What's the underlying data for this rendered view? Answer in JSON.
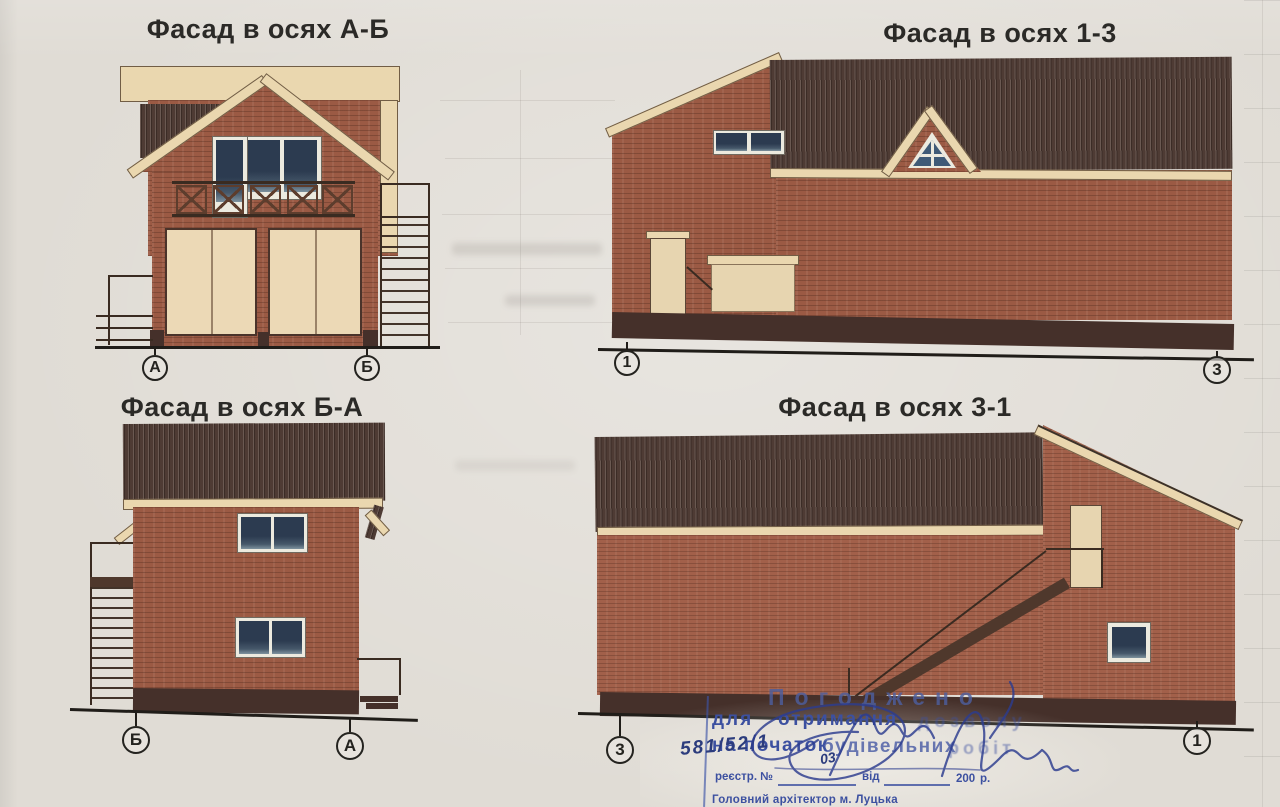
{
  "facades": [
    {
      "title": "Фасад в осях А-Б",
      "axis_left": "А",
      "axis_right": "Б"
    },
    {
      "title": "Фасад в осях 1-3",
      "axis_left": "1",
      "axis_right": "3"
    },
    {
      "title": "Фасад в осях Б-А",
      "axis_left": "Б",
      "axis_right": "А"
    },
    {
      "title": "Фасад в осях 3-1",
      "axis_left": "3",
      "axis_right": "1"
    }
  ],
  "stamp": {
    "approved": "Погоджено",
    "line2a": "для",
    "line2b": "отримання",
    "line2c": "дозволу",
    "line3a": "на початок",
    "line3b": "будівельних",
    "line3c": "робіт",
    "registry_label": "реєстр. №",
    "from_label": "від",
    "year": "200",
    "year_suffix": "р.",
    "signer": "Головний архітектор м. Луцька",
    "hand_number": "581/52/1",
    "hand_day": "03"
  },
  "colors": {
    "paper": "#e0dcd5",
    "brick": "#9b5a44",
    "brick_light": "#a2604a",
    "roof": "#4e3b34",
    "trim": "#ead7af",
    "glass": "#2c3b50",
    "plinth": "#45302a",
    "stamp_ink": "#3c50a0",
    "hand_ink": "#2c3c7d"
  }
}
